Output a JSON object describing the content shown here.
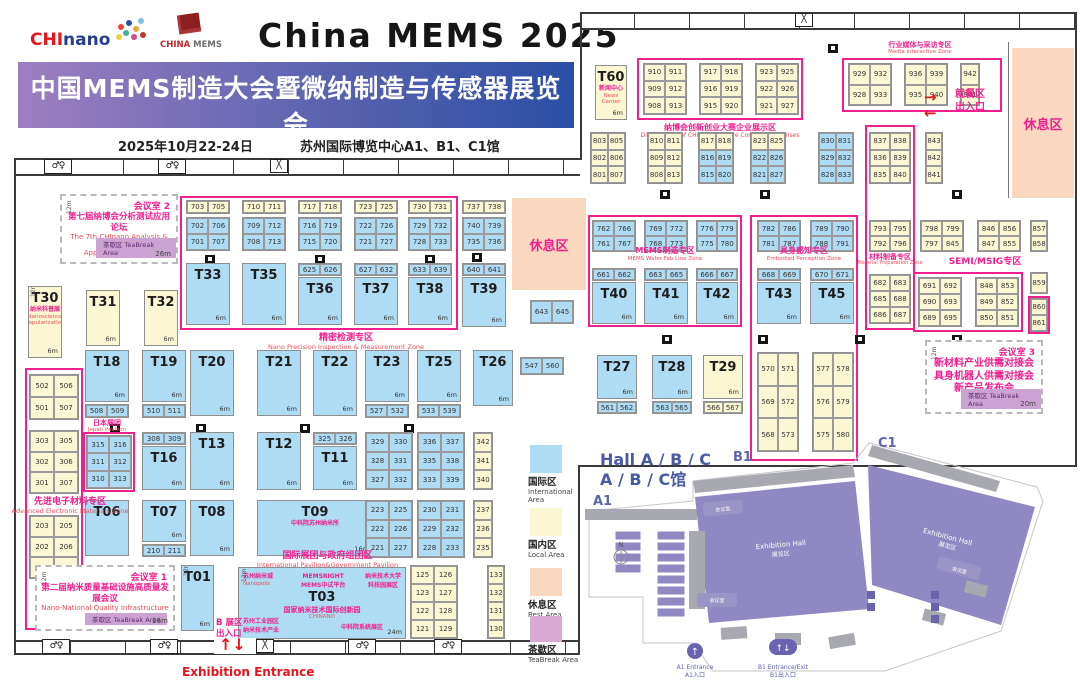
{
  "header": {
    "chinano_c1": "CHI",
    "chinano_c2": "nano",
    "chinamems_r": "CHINA ",
    "chinamems_g": "MEMS",
    "title": "China MEMS 2025",
    "banner_cn": "中国MEMS制造大会暨微纳制造与传感器展览会",
    "banner_en": "China MEMS Manufacturing Conference & China International Micro Nano Fabrication and Sensor Exhibition",
    "date": "2025年10月22-24日",
    "venue": "苏州国际博览中心A1、B1、C1馆"
  },
  "colors": {
    "booth_blue": "#aedcf4",
    "booth_yellow": "#fbf7d3",
    "zone_pink": "#ef1f8e",
    "rest_peach": "#f9d8bf",
    "teabreak_purple": "#cba3d3",
    "hall_purple": "#8f88c2",
    "banner_from": "#9d7fc0",
    "banner_to": "#2a4fa5",
    "red": "#e8141c"
  },
  "zones": {
    "precision": {
      "cn": "精密检测专区",
      "en": "Nano Precision Inspection & Measurement Zone"
    },
    "advanced": {
      "cn": "先进电子材料专区",
      "en": "Advanced Electronic Materials Zone"
    },
    "intl": {
      "cn": "国际展团与政府组团区",
      "en": "International Pavilion&Government Pavilion"
    },
    "japan": {
      "cn": "日本展团",
      "en": "Japan Pavilion"
    },
    "venture": {
      "cn": "纳博会创新创业大赛企业展示区",
      "en": "Display Area of CHInano Venture Contest Enterprises"
    },
    "media": {
      "cn": "行业媒体与采访专区",
      "en": "Media Interactive Zone"
    },
    "mems": {
      "cn": "MEMS制造专区",
      "en": "MEMS Wafer Fab Line Zone"
    },
    "embodied": {
      "cn": "具身感知专区",
      "en": "Embodied Perception Zone"
    },
    "material": {
      "cn": "材料制备专区",
      "en": "Material Preparation Zone"
    },
    "semi": {
      "cn": "SEMI/MSIG专区"
    }
  },
  "labels": {
    "rest": "休息区",
    "dining1": "就餐区",
    "dining2": "出入口",
    "entranceB1": "B 展区",
    "entranceB2": "出入口",
    "exhibition_entrance": "Exhibition Entrance"
  },
  "mr1": {
    "id": "会议室 1",
    "cn": "第二届纳米质量基础设施高质量发展会议",
    "en1": "Nano-National Quality Infrastructure (NQI)",
    "tea": "茶歇区 TeaBreak Area",
    "size": "26m",
    "depth": "12m"
  },
  "mr2": {
    "id": "会议室 2",
    "cn": "第七届纳博会分析测试应用论坛",
    "en1": "The 7th CHInano Analysis & Testing",
    "en2": "Application Seminar",
    "tea": "茶歇区 TeaBreak Area",
    "size": "26m",
    "depth": "12m"
  },
  "mr3": {
    "id": "会议室 3",
    "l1": "新材料产业供需对接会",
    "l2": "具身机器人供需对接会",
    "l3": "新产品发布会",
    "tea": "茶歇区 TeaBreak Area",
    "size": "20m",
    "depth": "12m"
  },
  "t03": {
    "id": "T03",
    "nanopolis_cn": "苏州纳米城",
    "nanopolis_en": "Nanopolis",
    "memsright": "MEMSRIGHT",
    "memsright2": "MEMS中试平台",
    "univ1": "纳米技术大学",
    "univ2": "科技园展区",
    "main": "国家纳米技术国际创新园",
    "chinano": "CHINANO",
    "sip1": "苏州工业园区",
    "sip2": "纳米技术产业",
    "cas": "中科院系统展区",
    "size": "24m",
    "depth": "12m"
  },
  "tbooths": {
    "t01": {
      "id": "T01",
      "size": "6m",
      "depth": "12m"
    },
    "t06": {
      "id": "T06"
    },
    "t07": {
      "id": "T07",
      "size": "6m"
    },
    "t08": {
      "id": "T08",
      "size": "6m"
    },
    "t09": {
      "id": "T09",
      "sub": "中科院苏州纳米所",
      "size": "16m"
    },
    "t11": {
      "id": "T11",
      "size": "6m"
    },
    "t12": {
      "id": "T12",
      "size": "6m"
    },
    "t13": {
      "id": "T13",
      "size": "6m"
    },
    "t16": {
      "id": "T16",
      "size": "6m"
    },
    "t18": {
      "id": "T18",
      "size": "6m"
    },
    "t19": {
      "id": "T19",
      "size": "6m"
    },
    "t20": {
      "id": "T20",
      "size": "6m"
    },
    "t21": {
      "id": "T21",
      "size": "6m"
    },
    "t22": {
      "id": "T22",
      "size": "6m"
    },
    "t23": {
      "id": "T23",
      "size": "6m"
    },
    "t25": {
      "id": "T25",
      "size": "6m"
    },
    "t26": {
      "id": "T26",
      "size": "6m"
    },
    "t27": {
      "id": "T27",
      "size": "6m"
    },
    "t28": {
      "id": "T28",
      "size": "6m"
    },
    "t29": {
      "id": "T29",
      "size": "6m"
    },
    "t30": {
      "id": "T30",
      "sub": "纳米科普展",
      "sub_en": "Nanoscience Popularization",
      "size": "6m",
      "depth": "12m"
    },
    "t31": {
      "id": "T31",
      "size": "6m"
    },
    "t32": {
      "id": "T32",
      "size": "6m"
    },
    "t33": {
      "id": "T33",
      "size": "6m"
    },
    "t35": {
      "id": "T35",
      "size": "6m"
    },
    "t36": {
      "id": "T36",
      "size": "6m"
    },
    "t37": {
      "id": "T37",
      "size": "6m"
    },
    "t38": {
      "id": "T38",
      "size": "6m"
    },
    "t39": {
      "id": "T39",
      "size": "6m"
    },
    "t40": {
      "id": "T40",
      "size": "6m"
    },
    "t41": {
      "id": "T41",
      "size": "6m"
    },
    "t42": {
      "id": "T42",
      "size": "6m"
    },
    "t43": {
      "id": "T43",
      "size": "6m"
    },
    "t45": {
      "id": "T45",
      "size": "6m"
    },
    "t60": {
      "id": "T60",
      "sub": "新闻中心",
      "sub_en": "News Center",
      "size": "6m"
    }
  },
  "groups": {
    "p703": [
      [
        "703",
        "705"
      ]
    ],
    "g701": [
      [
        "702",
        "706"
      ],
      [
        "701",
        "707"
      ]
    ],
    "p710": [
      [
        "710",
        "711"
      ]
    ],
    "g708": [
      [
        "709",
        "712"
      ],
      [
        "708",
        "713"
      ]
    ],
    "p717": [
      [
        "717",
        "718"
      ]
    ],
    "g715": [
      [
        "716",
        "719"
      ],
      [
        "715",
        "720"
      ]
    ],
    "p723": [
      [
        "723",
        "725"
      ]
    ],
    "g721": [
      [
        "722",
        "726"
      ],
      [
        "721",
        "727"
      ]
    ],
    "p730": [
      [
        "730",
        "731"
      ]
    ],
    "g728": [
      [
        "729",
        "732"
      ],
      [
        "728",
        "733"
      ]
    ],
    "p737": [
      [
        "737",
        "738"
      ]
    ],
    "g735": [
      [
        "740",
        "739"
      ],
      [
        "735",
        "736"
      ]
    ],
    "p625": [
      [
        "625",
        "626"
      ]
    ],
    "p627": [
      [
        "627",
        "632"
      ]
    ],
    "p633": [
      [
        "633",
        "639"
      ]
    ],
    "p640": [
      [
        "640",
        "641"
      ]
    ],
    "p643": [
      [
        "643",
        "645"
      ]
    ],
    "p508": [
      [
        "508",
        "509"
      ]
    ],
    "p510": [
      [
        "510",
        "511"
      ]
    ],
    "p527": [
      [
        "527",
        "532"
      ]
    ],
    "p533": [
      [
        "533",
        "539"
      ]
    ],
    "japan": [
      [
        "315",
        "316"
      ],
      [
        "311",
        "312"
      ],
      [
        "310",
        "313"
      ]
    ],
    "p308": [
      [
        "308",
        "309"
      ]
    ],
    "p325": [
      [
        "325",
        "326"
      ]
    ],
    "g320": [
      [
        "329",
        "330"
      ],
      [
        "328",
        "331"
      ],
      [
        "327",
        "332"
      ]
    ],
    "g330": [
      [
        "336",
        "337"
      ],
      [
        "335",
        "338"
      ],
      [
        "333",
        "339"
      ]
    ],
    "g340": [
      [
        "342"
      ],
      [
        "341"
      ],
      [
        "340"
      ]
    ],
    "p210": [
      [
        "210",
        "211"
      ]
    ],
    "g220": [
      [
        "223",
        "225"
      ],
      [
        "222",
        "226"
      ],
      [
        "221",
        "227"
      ]
    ],
    "g230": [
      [
        "230",
        "231"
      ],
      [
        "229",
        "232"
      ],
      [
        "228",
        "233"
      ]
    ],
    "g235": [
      [
        "237"
      ],
      [
        "236"
      ],
      [
        "235"
      ]
    ],
    "g500": [
      [
        "502",
        "506"
      ],
      [
        "501",
        "507"
      ]
    ],
    "g300": [
      [
        "303",
        "305"
      ],
      [
        "302",
        "306"
      ],
      [
        "301",
        "307"
      ]
    ],
    "g200": [
      [
        "203",
        "205"
      ],
      [
        "202",
        "206"
      ],
      [
        "201",
        "207"
      ]
    ],
    "g120": [
      [
        "125",
        "126"
      ],
      [
        "123",
        "127"
      ],
      [
        "122",
        "128"
      ],
      [
        "121",
        "129"
      ]
    ],
    "g130": [
      [
        "133"
      ],
      [
        "132"
      ],
      [
        "131"
      ],
      [
        "130"
      ]
    ],
    "p547": [
      [
        "547",
        "560"
      ]
    ],
    "g910": [
      [
        "910",
        "911"
      ],
      [
        "909",
        "912"
      ],
      [
        "908",
        "913"
      ]
    ],
    "g917": [
      [
        "917",
        "918"
      ],
      [
        "916",
        "919"
      ],
      [
        "915",
        "920"
      ]
    ],
    "g923": [
      [
        "923",
        "925"
      ],
      [
        "922",
        "926"
      ],
      [
        "921",
        "927"
      ]
    ],
    "g929": [
      [
        "929",
        "932"
      ],
      [
        "928",
        "933"
      ]
    ],
    "g936": [
      [
        "936",
        "939"
      ],
      [
        "935",
        "940"
      ]
    ],
    "g942": [
      [
        "942"
      ],
      [
        "941"
      ]
    ],
    "g800a": [
      [
        "803",
        "805"
      ],
      [
        "802",
        "806"
      ],
      [
        "801",
        "807"
      ]
    ],
    "g800b": [
      [
        "810",
        "811"
      ],
      [
        "809",
        "812"
      ],
      [
        "808",
        "813"
      ]
    ],
    "g800c": [
      [
        "817",
        "818"
      ],
      [
        "816",
        "819"
      ],
      [
        "815",
        "820"
      ]
    ],
    "g800d": [
      [
        "823",
        "825"
      ],
      [
        "822",
        "826"
      ],
      [
        "821",
        "827"
      ]
    ],
    "g800e": [
      [
        "830",
        "831"
      ],
      [
        "829",
        "832"
      ],
      [
        "828",
        "833"
      ]
    ],
    "g837": [
      [
        "837",
        "838"
      ],
      [
        "836",
        "839"
      ],
      [
        "835",
        "840"
      ]
    ],
    "g843": [
      [
        "843"
      ],
      [
        "842"
      ],
      [
        "841"
      ]
    ],
    "g760a": [
      [
        "762",
        "766"
      ],
      [
        "761",
        "767"
      ]
    ],
    "g760b": [
      [
        "769",
        "772"
      ],
      [
        "768",
        "773"
      ]
    ],
    "g760c": [
      [
        "776",
        "779"
      ],
      [
        "775",
        "780"
      ]
    ],
    "p661": [
      [
        "661",
        "662"
      ]
    ],
    "p663": [
      [
        "663",
        "665"
      ]
    ],
    "p666": [
      [
        "666",
        "667"
      ]
    ],
    "g780a": [
      [
        "782",
        "786"
      ],
      [
        "781",
        "787"
      ]
    ],
    "g780b": [
      [
        "789",
        "790"
      ],
      [
        "788",
        "791"
      ]
    ],
    "p668": [
      [
        "668",
        "669"
      ]
    ],
    "p670": [
      [
        "670",
        "671"
      ]
    ],
    "g570a": [
      [
        "570",
        "571"
      ],
      [
        "569",
        "572"
      ],
      [
        "568",
        "573"
      ]
    ],
    "g570b": [
      [
        "577",
        "578"
      ],
      [
        "576",
        "579"
      ],
      [
        "575",
        "580"
      ]
    ],
    "g790c": [
      [
        "793",
        "795"
      ],
      [
        "792",
        "796"
      ]
    ],
    "g680": [
      [
        "682",
        "683"
      ],
      [
        "685",
        "688"
      ],
      [
        "686",
        "687"
      ]
    ],
    "g798": [
      [
        "798",
        "799"
      ],
      [
        "797",
        "845"
      ]
    ],
    "g846": [
      [
        "846",
        "856"
      ],
      [
        "847",
        "855"
      ]
    ],
    "g857": [
      [
        "857"
      ],
      [
        "858"
      ]
    ],
    "g690": [
      [
        "691",
        "692"
      ],
      [
        "690",
        "693"
      ],
      [
        "689",
        "695"
      ]
    ],
    "g848": [
      [
        "848",
        "853"
      ],
      [
        "849",
        "852"
      ],
      [
        "850",
        "851"
      ]
    ],
    "g859": [
      [
        "859"
      ]
    ],
    "g860": [
      [
        "860"
      ],
      [
        "861"
      ]
    ],
    "p561": [
      [
        "561",
        "562"
      ]
    ],
    "p563": [
      [
        "563",
        "565"
      ]
    ],
    "p566": [
      [
        "566",
        "567"
      ]
    ]
  },
  "legend": [
    {
      "cn": "国际区",
      "en": "International Area",
      "hex": "#aedcf4"
    },
    {
      "cn": "国内区",
      "en": "Local Area",
      "hex": "#fbf7d3"
    },
    {
      "cn": "休息区",
      "en": "Rest Area",
      "hex": "#f9d8bf"
    },
    {
      "cn": "茶歇区",
      "en": "TeaBreak Area",
      "hex": "#d9a8d5"
    }
  ],
  "hall_map": {
    "title1": "Hall A / B / C",
    "title2": "A / B / C馆",
    "a1": "A1",
    "b1": "B1",
    "c1": "C1",
    "hall_en": "Exhibition Hall",
    "hall_cn": "展览区",
    "meeting_en": "Meeting room",
    "meeting_cn": "会议室",
    "a1_entrance_en": "A1 Entrance",
    "a1_entrance_cn": "A1入口",
    "b1_entrance_en": "B1 Entrance/Exit",
    "b1_entrance_cn": "B1出入口",
    "north": "N"
  }
}
